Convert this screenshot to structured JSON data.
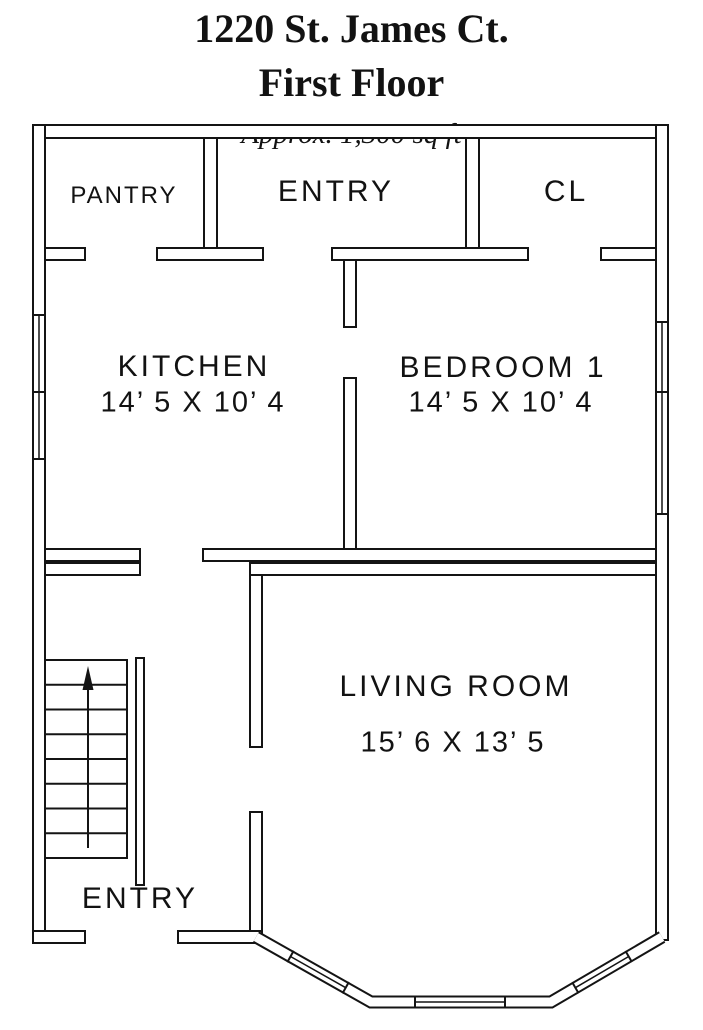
{
  "title": {
    "address": "1220 St. James Ct.",
    "floor": "First Floor",
    "area_note": "Approx. 1,300 sq ft"
  },
  "rooms": {
    "pantry": {
      "label": "PANTRY"
    },
    "entry_top": {
      "label": "ENTRY"
    },
    "closet": {
      "label": "CL"
    },
    "kitchen": {
      "label": "KITCHEN",
      "dimensions": "14’ 5 X 10’ 4"
    },
    "bedroom_1": {
      "label": "BEDROOM 1",
      "dimensions": "14’ 5 X 10’ 4"
    },
    "living_room": {
      "label": "LIVING ROOM",
      "dimensions": "15’ 6 X 13’ 5"
    },
    "entry_bottom": {
      "label": "ENTRY"
    }
  },
  "colors": {
    "wall": "#141414",
    "background": "#ffffff",
    "text": "#121212"
  }
}
